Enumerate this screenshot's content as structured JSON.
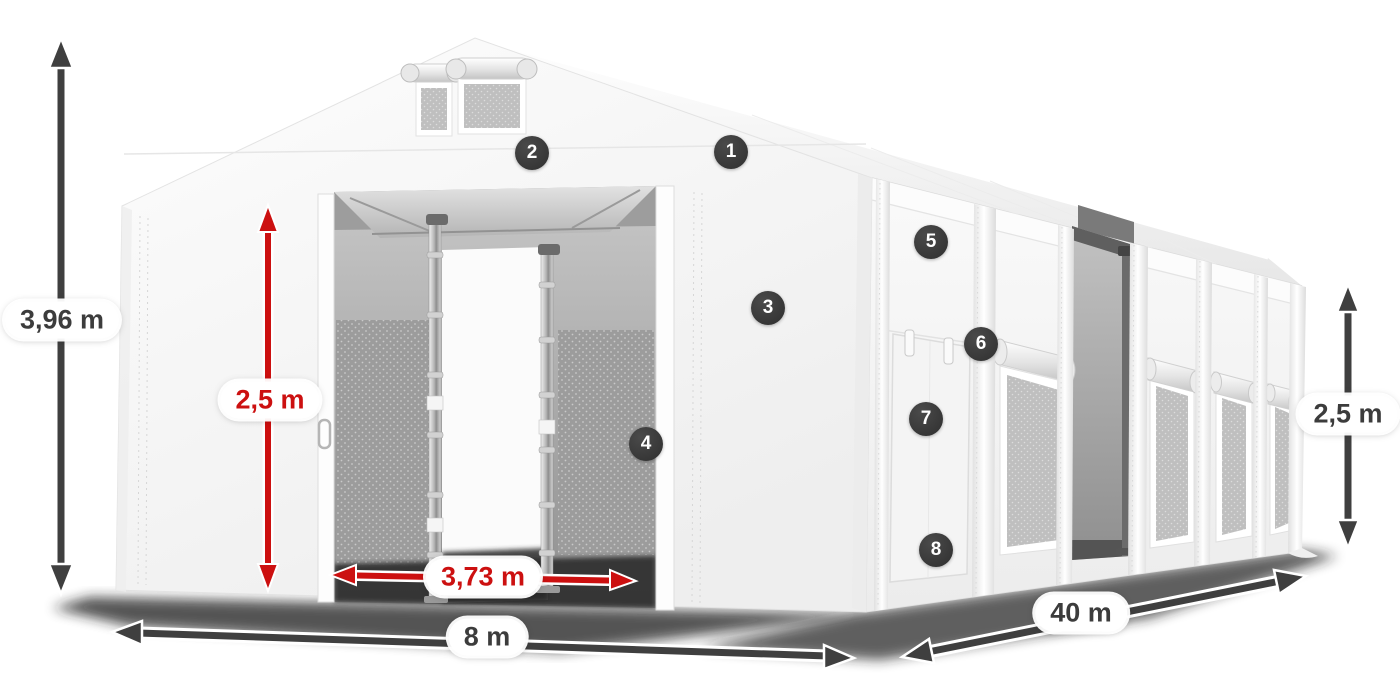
{
  "illustration": {
    "subject": "white storage tent with dimension annotations",
    "colors": {
      "dimension_dark": "#3f3f3f",
      "dimension_red": "#cc1010",
      "badge_bg": "#333333",
      "badge_text": "#ffffff",
      "pill_bg": "#ffffff"
    },
    "dimensions": {
      "total_height": {
        "label": "3,96 m",
        "style": "dark",
        "orientation": "vertical"
      },
      "door_height": {
        "label": "2,5 m",
        "style": "red",
        "orientation": "vertical"
      },
      "door_width": {
        "label": "3,73 m",
        "style": "red",
        "orientation": "horizontal"
      },
      "front_width": {
        "label": "8 m",
        "style": "dark",
        "orientation": "horizontal"
      },
      "side_length": {
        "label": "40 m",
        "style": "dark",
        "orientation": "diagonal"
      },
      "side_height": {
        "label": "2,5 m",
        "style": "dark",
        "orientation": "vertical"
      }
    },
    "callouts": {
      "c1": {
        "number": "1"
      },
      "c2": {
        "number": "2"
      },
      "c3": {
        "number": "3"
      },
      "c4": {
        "number": "4"
      },
      "c5": {
        "number": "5"
      },
      "c6": {
        "number": "6"
      },
      "c7": {
        "number": "7"
      },
      "c8": {
        "number": "8"
      }
    }
  }
}
